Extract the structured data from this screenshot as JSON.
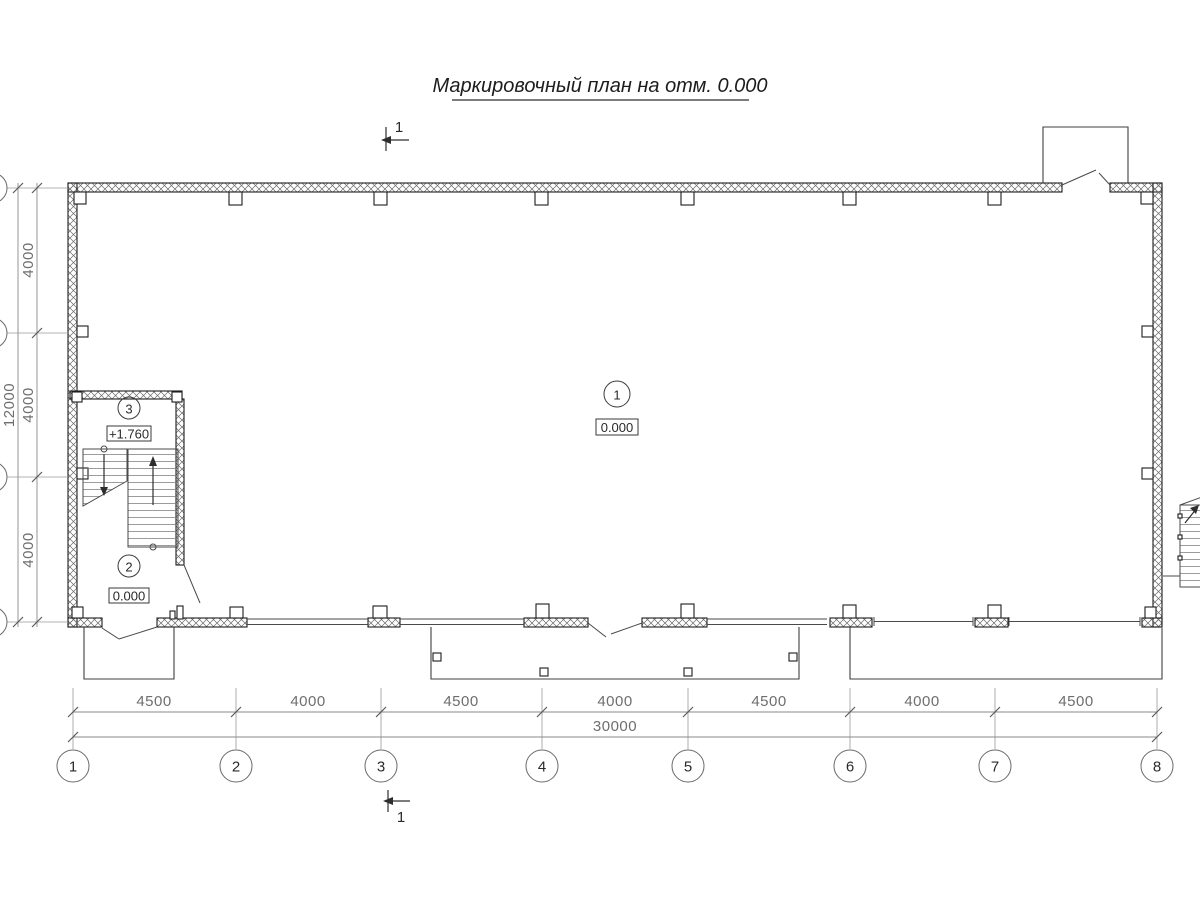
{
  "title": "Маркировочный план на отм. 0.000",
  "section_marks": {
    "top": "1",
    "bottom": "1"
  },
  "rooms": {
    "hall": {
      "number": "1",
      "elevation": "0.000"
    },
    "vestibule": {
      "number": "2",
      "elevation": "0.000"
    },
    "stair_landing": {
      "number": "3",
      "elevation": "+1.760"
    }
  },
  "grid": {
    "columns": [
      "1",
      "2",
      "3",
      "4",
      "5",
      "6",
      "7",
      "8"
    ],
    "bottom_dims": [
      "4500",
      "4000",
      "4500",
      "4000",
      "4500",
      "4000",
      "4500"
    ],
    "bottom_total": "30000",
    "left_dims": [
      "4000",
      "4000",
      "4000"
    ],
    "left_total": "12000"
  },
  "colors": {
    "drawing_line": "#1d1d1d",
    "dimension_line": "#8a8a8a"
  }
}
